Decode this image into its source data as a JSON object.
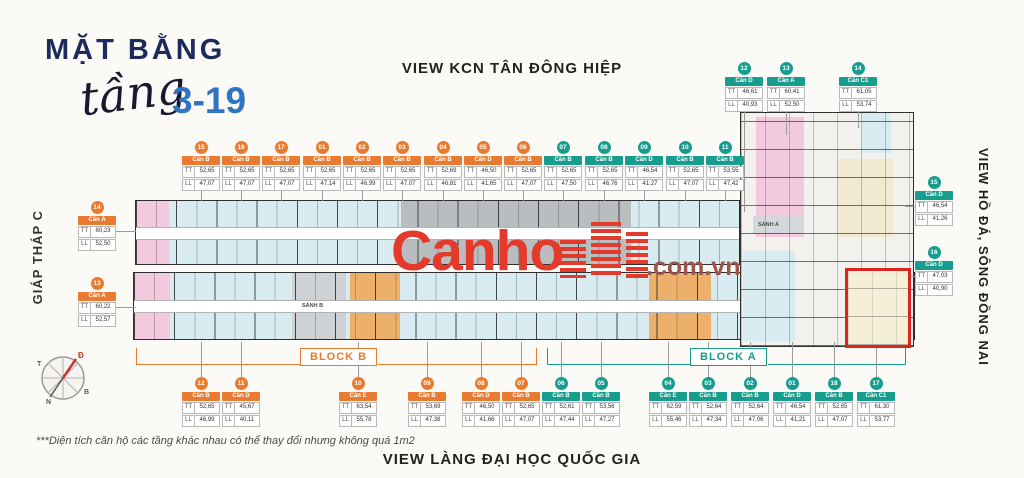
{
  "header": {
    "title": "MẶT BẰNG",
    "subtitle_script": "tầng",
    "floor_range": "3-19"
  },
  "views": {
    "top": "VIEW KCN TÂN ĐÔNG HIỆP",
    "bottom": "VIEW LÀNG ĐẠI HỌC QUỐC GIA",
    "left": "GIÁP THÁP C",
    "right": "VIEW HỒ ĐÁ, SÔNG ĐỒNG NAI"
  },
  "blocks": {
    "block_b": "BLOCK B",
    "block_a": "BLOCK A"
  },
  "lobbies": {
    "lobby_a": "SẢNH A",
    "lobby_b": "SẢNH B"
  },
  "watermark": {
    "brand": "Canho",
    "suffix": ".com.vn"
  },
  "footnote": "***Diện tích căn hộ các tầng khác nhau có thể thay đổi nhưng không quá 1m2",
  "field_labels": {
    "area1": "TT",
    "area2": "LL"
  },
  "compass": {
    "east": "Đ",
    "west": "T",
    "south": "N",
    "north": "B"
  },
  "colors": {
    "orange": "#e87b2f",
    "teal": "#169d8e",
    "navy": "#1d2a5c",
    "blue": "#2e74c0",
    "red": "#d8261f",
    "watermark_red": "#e43a2c"
  },
  "unit_labels": {
    "top_row": [
      {
        "no": "15",
        "type": "Căn B",
        "tt": "52,65",
        "ll": "47,07",
        "c": "orange"
      },
      {
        "no": "16",
        "type": "Căn B",
        "tt": "52,65",
        "ll": "47,07",
        "c": "orange"
      },
      {
        "no": "17",
        "type": "Căn B",
        "tt": "52,65",
        "ll": "47,07",
        "c": "orange"
      },
      {
        "no": "01",
        "type": "Căn B",
        "tt": "52,65",
        "ll": "47,14",
        "c": "orange"
      },
      {
        "no": "02",
        "type": "Căn B",
        "tt": "52,65",
        "ll": "46,99",
        "c": "orange"
      },
      {
        "no": "03",
        "type": "Căn B",
        "tt": "52,65",
        "ll": "47,07",
        "c": "orange"
      },
      {
        "no": "04",
        "type": "Căn B",
        "tt": "52,69",
        "ll": "46,81",
        "c": "orange"
      },
      {
        "no": "05",
        "type": "Căn D",
        "tt": "46,50",
        "ll": "41,65",
        "c": "orange"
      },
      {
        "no": "06",
        "type": "Căn B",
        "tt": "52,65",
        "ll": "47,07",
        "c": "orange"
      },
      {
        "no": "07",
        "type": "Căn B",
        "tt": "52,65",
        "ll": "47,50",
        "c": "teal"
      },
      {
        "no": "08",
        "type": "Căn B",
        "tt": "52,65",
        "ll": "46,76",
        "c": "teal"
      },
      {
        "no": "09",
        "type": "Căn D",
        "tt": "46,54",
        "ll": "41,27",
        "c": "teal"
      },
      {
        "no": "10",
        "type": "Căn B",
        "tt": "52,65",
        "ll": "47,07",
        "c": "teal"
      },
      {
        "no": "11",
        "type": "Căn B",
        "tt": "53,55",
        "ll": "47,42",
        "c": "teal"
      }
    ],
    "top_right": [
      {
        "no": "12",
        "type": "Căn D",
        "tt": "46,61",
        "ll": "40,93",
        "c": "teal"
      },
      {
        "no": "13",
        "type": "Căn A",
        "tt": "60,41",
        "ll": "52,50",
        "c": "teal"
      },
      {
        "no": "14",
        "type": "Căn C1",
        "tt": "61,05",
        "ll": "53,74",
        "c": "teal"
      }
    ],
    "left_col": [
      {
        "no": "14",
        "type": "Căn A",
        "tt": "60,23",
        "ll": "52,50",
        "c": "orange"
      },
      {
        "no": "13",
        "type": "Căn A",
        "tt": "60,22",
        "ll": "52,57",
        "c": "orange"
      }
    ],
    "right_col": [
      {
        "no": "15",
        "type": "Căn D",
        "tt": "46,54",
        "ll": "41,26",
        "c": "teal"
      },
      {
        "no": "16",
        "type": "Căn D",
        "tt": "47,03",
        "ll": "40,90",
        "c": "teal"
      }
    ],
    "bottom_row": [
      {
        "no": "12",
        "type": "Căn B",
        "tt": "52,65",
        "ll": "46,99",
        "c": "orange"
      },
      {
        "no": "11",
        "type": "Căn D",
        "tt": "45,67",
        "ll": "40,11",
        "c": "orange"
      },
      {
        "no": "10",
        "type": "Căn E",
        "tt": "63,54",
        "ll": "55,78",
        "c": "orange"
      },
      {
        "no": "09",
        "type": "Căn B",
        "tt": "53,69",
        "ll": "47,38",
        "c": "orange"
      },
      {
        "no": "08",
        "type": "Căn D",
        "tt": "46,50",
        "ll": "41,66",
        "c": "orange"
      },
      {
        "no": "07",
        "type": "Căn B",
        "tt": "52,65",
        "ll": "47,07",
        "c": "orange"
      },
      {
        "no": "06",
        "type": "Căn B",
        "tt": "52,61",
        "ll": "47,44",
        "c": "teal"
      },
      {
        "no": "05",
        "type": "Căn B",
        "tt": "53,56",
        "ll": "47,27",
        "c": "teal"
      },
      {
        "no": "04",
        "type": "Căn E",
        "tt": "62,59",
        "ll": "55,46",
        "c": "teal"
      },
      {
        "no": "03",
        "type": "Căn B",
        "tt": "52,64",
        "ll": "47,34",
        "c": "teal"
      },
      {
        "no": "02",
        "type": "Căn B",
        "tt": "52,64",
        "ll": "47,06",
        "c": "teal"
      },
      {
        "no": "01",
        "type": "Căn D",
        "tt": "46,54",
        "ll": "41,21",
        "c": "teal"
      },
      {
        "no": "18",
        "type": "Căn B",
        "tt": "52,65",
        "ll": "47,07",
        "c": "teal"
      },
      {
        "no": "17",
        "type": "Căn C1",
        "tt": "61,30",
        "ll": "53,77",
        "c": "teal"
      }
    ]
  }
}
